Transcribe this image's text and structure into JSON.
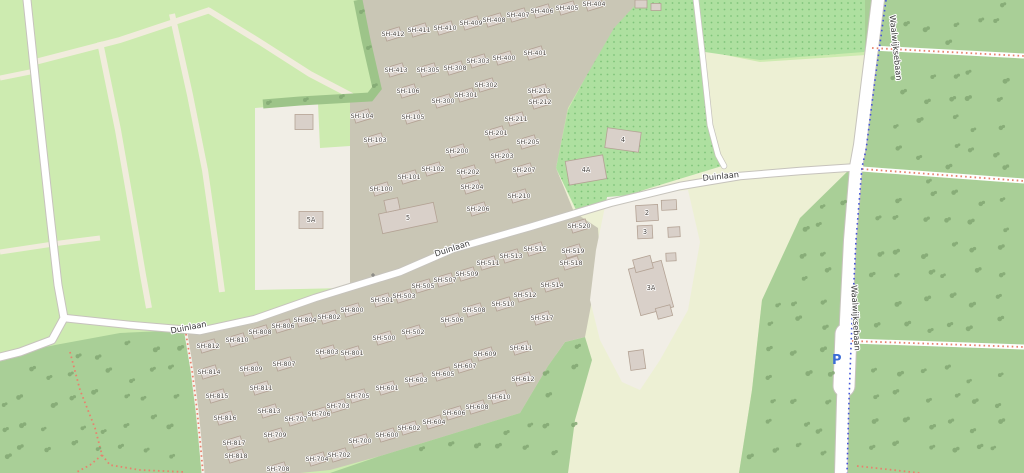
{
  "map_labels": {
    "duinlaan": "Duinlaan",
    "waalwijksebaan": "Waalwijksebaan",
    "parking": "P"
  },
  "colors": {
    "field": "#cdebb0",
    "farmland": "#edf0d4",
    "forest": "#a9cf97",
    "orchard": "#aee0a0",
    "orchard_dot": "#7fc47a",
    "hedge": "#9dc489",
    "tree": "#83a873",
    "tan_area": "#c9c6b5",
    "beige_area": "#f1eee6",
    "road": "#ffffff",
    "casing": "#c6c3bc",
    "track": "#f1ecdd",
    "path_red": "#e7826e",
    "route_blue": "#4254d8",
    "building": "#d9d0c9",
    "building_stroke": "#b3a294",
    "label": "#4c4742",
    "road_label": "#3a3a3a",
    "parking_blue": "#3b6cd6",
    "marker_gray": "#7a7a78"
  },
  "bungalows": [
    {
      "l": "SH-100",
      "x": 381,
      "y": 189
    },
    {
      "l": "SH-101",
      "x": 409,
      "y": 177
    },
    {
      "l": "SH-102",
      "x": 433,
      "y": 169
    },
    {
      "l": "SH-103",
      "x": 375,
      "y": 140
    },
    {
      "l": "SH-104",
      "x": 362,
      "y": 116
    },
    {
      "l": "SH-105",
      "x": 413,
      "y": 117
    },
    {
      "l": "SH-106",
      "x": 408,
      "y": 91
    },
    {
      "l": "SH-200",
      "x": 457,
      "y": 151
    },
    {
      "l": "SH-201",
      "x": 496,
      "y": 133
    },
    {
      "l": "SH-202",
      "x": 468,
      "y": 172
    },
    {
      "l": "SH-203",
      "x": 502,
      "y": 156
    },
    {
      "l": "SH-204",
      "x": 472,
      "y": 187
    },
    {
      "l": "SH-205",
      "x": 528,
      "y": 142
    },
    {
      "l": "SH-206",
      "x": 478,
      "y": 209
    },
    {
      "l": "SH-207",
      "x": 524,
      "y": 170
    },
    {
      "l": "SH-210",
      "x": 519,
      "y": 196
    },
    {
      "l": "SH-211",
      "x": 516,
      "y": 119
    },
    {
      "l": "SH-212",
      "x": 540,
      "y": 102
    },
    {
      "l": "SH-213",
      "x": 539,
      "y": 91
    },
    {
      "l": "SH-300",
      "x": 443,
      "y": 101
    },
    {
      "l": "SH-301",
      "x": 466,
      "y": 95
    },
    {
      "l": "SH-302",
      "x": 486,
      "y": 85
    },
    {
      "l": "SH-303",
      "x": 478,
      "y": 61
    },
    {
      "l": "SH-305",
      "x": 428,
      "y": 70
    },
    {
      "l": "SH-308",
      "x": 455,
      "y": 68
    },
    {
      "l": "SH-400",
      "x": 504,
      "y": 58
    },
    {
      "l": "SH-401",
      "x": 535,
      "y": 53
    },
    {
      "l": "SH-404",
      "x": 594,
      "y": 4
    },
    {
      "l": "SH-405",
      "x": 567,
      "y": 8
    },
    {
      "l": "SH-406",
      "x": 542,
      "y": 11
    },
    {
      "l": "SH-407",
      "x": 518,
      "y": 15
    },
    {
      "l": "SH-408",
      "x": 494,
      "y": 20
    },
    {
      "l": "SH-409",
      "x": 471,
      "y": 23
    },
    {
      "l": "SH-410",
      "x": 445,
      "y": 28
    },
    {
      "l": "SH-411",
      "x": 419,
      "y": 30
    },
    {
      "l": "SH-412",
      "x": 393,
      "y": 34
    },
    {
      "l": "SH-413",
      "x": 396,
      "y": 70
    },
    {
      "l": "SH-500",
      "x": 384,
      "y": 338
    },
    {
      "l": "SH-501",
      "x": 382,
      "y": 300
    },
    {
      "l": "SH-502",
      "x": 413,
      "y": 332
    },
    {
      "l": "SH-503",
      "x": 404,
      "y": 296
    },
    {
      "l": "SH-505",
      "x": 423,
      "y": 286
    },
    {
      "l": "SH-506",
      "x": 452,
      "y": 320
    },
    {
      "l": "SH-507",
      "x": 445,
      "y": 280
    },
    {
      "l": "SH-508",
      "x": 474,
      "y": 310
    },
    {
      "l": "SH-509",
      "x": 467,
      "y": 274
    },
    {
      "l": "SH-510",
      "x": 503,
      "y": 304
    },
    {
      "l": "SH-511",
      "x": 488,
      "y": 263
    },
    {
      "l": "SH-512",
      "x": 525,
      "y": 295
    },
    {
      "l": "SH-513",
      "x": 511,
      "y": 256
    },
    {
      "l": "SH-514",
      "x": 552,
      "y": 285
    },
    {
      "l": "SH-515",
      "x": 535,
      "y": 249
    },
    {
      "l": "SH-517",
      "x": 542,
      "y": 318
    },
    {
      "l": "SH-518",
      "x": 571,
      "y": 263
    },
    {
      "l": "SH-519",
      "x": 573,
      "y": 251
    },
    {
      "l": "SH-520",
      "x": 579,
      "y": 226
    },
    {
      "l": "SH-600",
      "x": 387,
      "y": 435
    },
    {
      "l": "SH-601",
      "x": 387,
      "y": 388
    },
    {
      "l": "SH-602",
      "x": 409,
      "y": 428
    },
    {
      "l": "SH-603",
      "x": 416,
      "y": 380
    },
    {
      "l": "SH-604",
      "x": 434,
      "y": 422
    },
    {
      "l": "SH-605",
      "x": 443,
      "y": 374
    },
    {
      "l": "SH-606",
      "x": 454,
      "y": 413
    },
    {
      "l": "SH-607",
      "x": 465,
      "y": 366
    },
    {
      "l": "SH-608",
      "x": 477,
      "y": 407
    },
    {
      "l": "SH-609",
      "x": 485,
      "y": 354
    },
    {
      "l": "SH-610",
      "x": 499,
      "y": 397
    },
    {
      "l": "SH-611",
      "x": 521,
      "y": 348
    },
    {
      "l": "SH-612",
      "x": 523,
      "y": 379
    },
    {
      "l": "SH-700",
      "x": 360,
      "y": 441
    },
    {
      "l": "SH-702",
      "x": 339,
      "y": 455
    },
    {
      "l": "SH-703",
      "x": 338,
      "y": 406
    },
    {
      "l": "SH-704",
      "x": 317,
      "y": 459
    },
    {
      "l": "SH-705",
      "x": 358,
      "y": 396
    },
    {
      "l": "SH-706",
      "x": 319,
      "y": 414
    },
    {
      "l": "SH-707",
      "x": 296,
      "y": 419
    },
    {
      "l": "SH-708",
      "x": 278,
      "y": 469
    },
    {
      "l": "SH-709",
      "x": 275,
      "y": 435
    },
    {
      "l": "SH-800",
      "x": 352,
      "y": 310
    },
    {
      "l": "SH-801",
      "x": 352,
      "y": 353
    },
    {
      "l": "SH-802",
      "x": 329,
      "y": 317
    },
    {
      "l": "SH-803",
      "x": 327,
      "y": 352
    },
    {
      "l": "SH-804",
      "x": 305,
      "y": 320
    },
    {
      "l": "SH-806",
      "x": 283,
      "y": 326
    },
    {
      "l": "SH-807",
      "x": 284,
      "y": 364
    },
    {
      "l": "SH-808",
      "x": 260,
      "y": 332
    },
    {
      "l": "SH-809",
      "x": 251,
      "y": 369
    },
    {
      "l": "SH-810",
      "x": 237,
      "y": 340
    },
    {
      "l": "SH-811",
      "x": 261,
      "y": 388
    },
    {
      "l": "SH-812",
      "x": 208,
      "y": 346
    },
    {
      "l": "SH-813",
      "x": 269,
      "y": 411
    },
    {
      "l": "SH-814",
      "x": 209,
      "y": 372
    },
    {
      "l": "SH-815",
      "x": 217,
      "y": 396
    },
    {
      "l": "SH-816",
      "x": 225,
      "y": 418
    },
    {
      "l": "SH-817",
      "x": 234,
      "y": 443
    },
    {
      "l": "SH-818",
      "x": 236,
      "y": 456
    }
  ],
  "numbered_buildings": [
    {
      "l": "5",
      "x": 408,
      "y": 218,
      "w": 56,
      "h": 20,
      "r": -12
    },
    {
      "l": "5A",
      "x": 311,
      "y": 220,
      "w": 24,
      "h": 17,
      "r": 0
    },
    {
      "l": "4",
      "x": 623,
      "y": 140,
      "w": 34,
      "h": 20,
      "r": 8
    },
    {
      "l": "4A",
      "x": 586,
      "y": 170,
      "w": 38,
      "h": 24,
      "r": -10
    },
    {
      "l": "2",
      "x": 647,
      "y": 213,
      "w": 22,
      "h": 16,
      "r": -3
    },
    {
      "l": "3",
      "x": 645,
      "y": 232,
      "w": 15,
      "h": 13,
      "r": -3
    },
    {
      "l": "3A",
      "x": 651,
      "y": 288,
      "w": 34,
      "h": 48,
      "r": -15
    }
  ]
}
